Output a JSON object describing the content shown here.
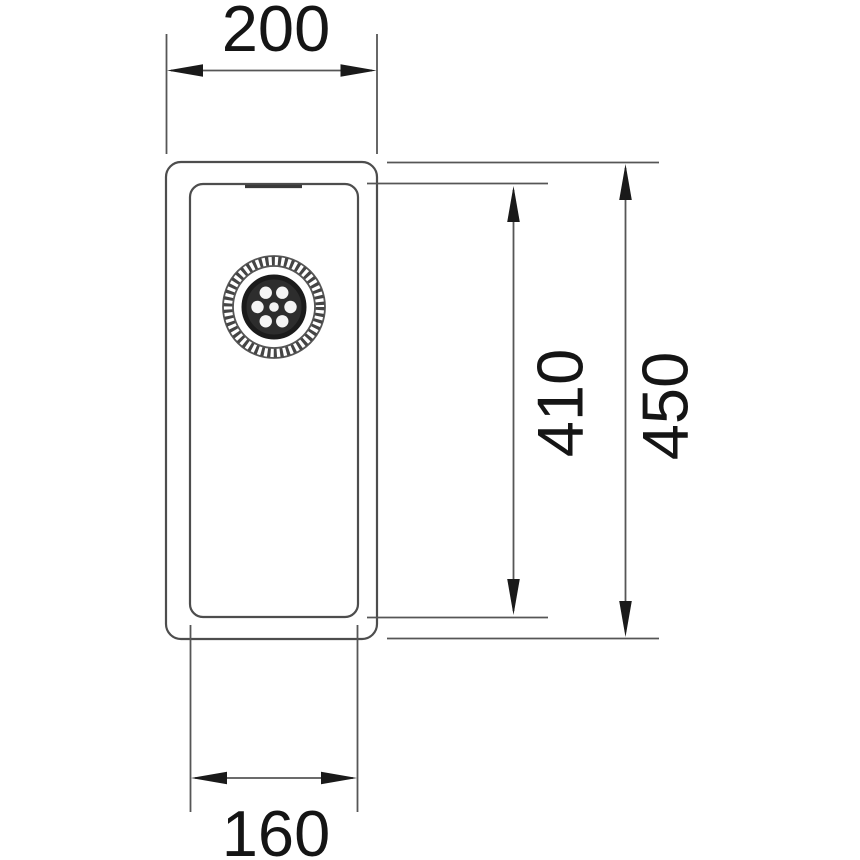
{
  "diagram": {
    "subject": "sink-top-view-technical-drawing",
    "background_color": "#ffffff",
    "line_color": "#4d4d4d",
    "arrow_color": "#1a1a1a",
    "text_color": "#151515",
    "drain_icon": "drain-strainer-icon"
  },
  "dimensions": {
    "outer_width": {
      "label": "200",
      "position": "top"
    },
    "bowl_depth": {
      "label": "410",
      "position": "right-inner"
    },
    "outer_depth": {
      "label": "450",
      "position": "right-outer"
    },
    "bowl_width": {
      "label": "160",
      "position": "bottom"
    }
  }
}
